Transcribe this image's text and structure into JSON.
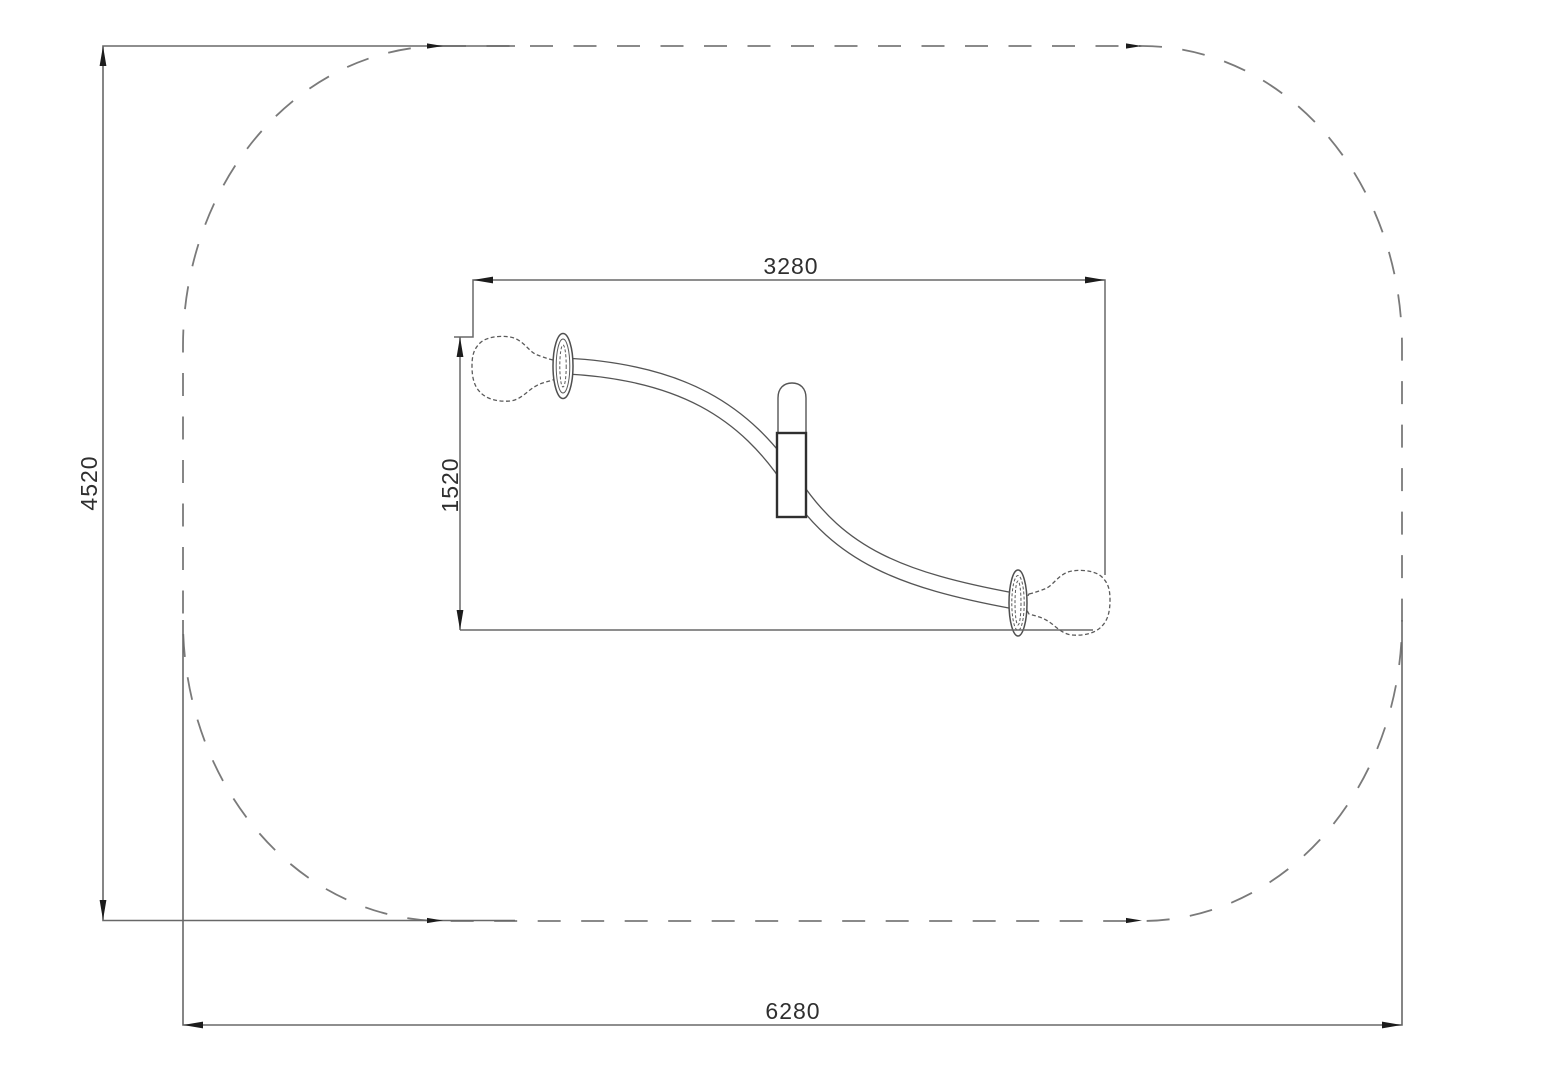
{
  "drawing": {
    "type": "technical-plan-view",
    "labels": {
      "overall_depth": "4520",
      "overall_width": "6280",
      "equipment_length": "3280",
      "equipment_width": "1520"
    },
    "colors": {
      "background": "#ffffff",
      "boundary_dash": "#7a7a7a",
      "dimension_line": "#686868",
      "arrow": "#1c1c1c",
      "object_line": "#555555",
      "text": "#2f2f2f"
    },
    "boundary_style": "dashed-rounded-rectangle"
  }
}
